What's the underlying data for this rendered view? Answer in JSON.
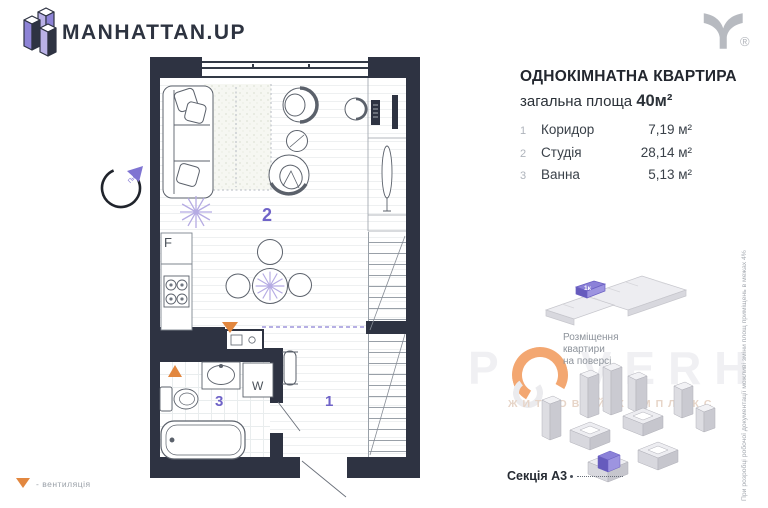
{
  "header": {
    "brand": "MANHATTAN.UP",
    "trademark": "®"
  },
  "apartment": {
    "title": "ОДНОКІМНАТНА КВАРТИРА",
    "area_label": "загальна площа",
    "area_value": "40м²",
    "rooms": [
      {
        "num": "1",
        "name": "Коридор",
        "area": "7,19 м²"
      },
      {
        "num": "2",
        "name": "Студія",
        "area": "28,14 м²"
      },
      {
        "num": "3",
        "name": "Ванна",
        "area": "5,13 м²"
      }
    ]
  },
  "plan": {
    "labels": {
      "corridor": "1",
      "studio": "2",
      "bathroom": "3",
      "fridge": "F",
      "washer": "W",
      "north": "Пн"
    },
    "legend_text": "- вентиляція"
  },
  "location": {
    "unit_tag": "1к",
    "note_lines": [
      "Розміщення",
      "квартири",
      "на поверсі"
    ],
    "section_label": "Секція А3"
  },
  "watermark": {
    "letters": [
      "P",
      "V",
      "E",
      "R",
      "H"
    ],
    "subtitle": "ЖИТЛОВИЙ КОМПЛЕКС"
  },
  "disclaimer": "При розробці робочої документації можливі зміни площ приміщень в межах 4%",
  "colors": {
    "wall": "#2e3342",
    "accent_purple": "#6f63c8",
    "plant_purple": "#b5abe3",
    "vent_orange": "#e2873f",
    "watermark_orange": "#f3a771"
  }
}
